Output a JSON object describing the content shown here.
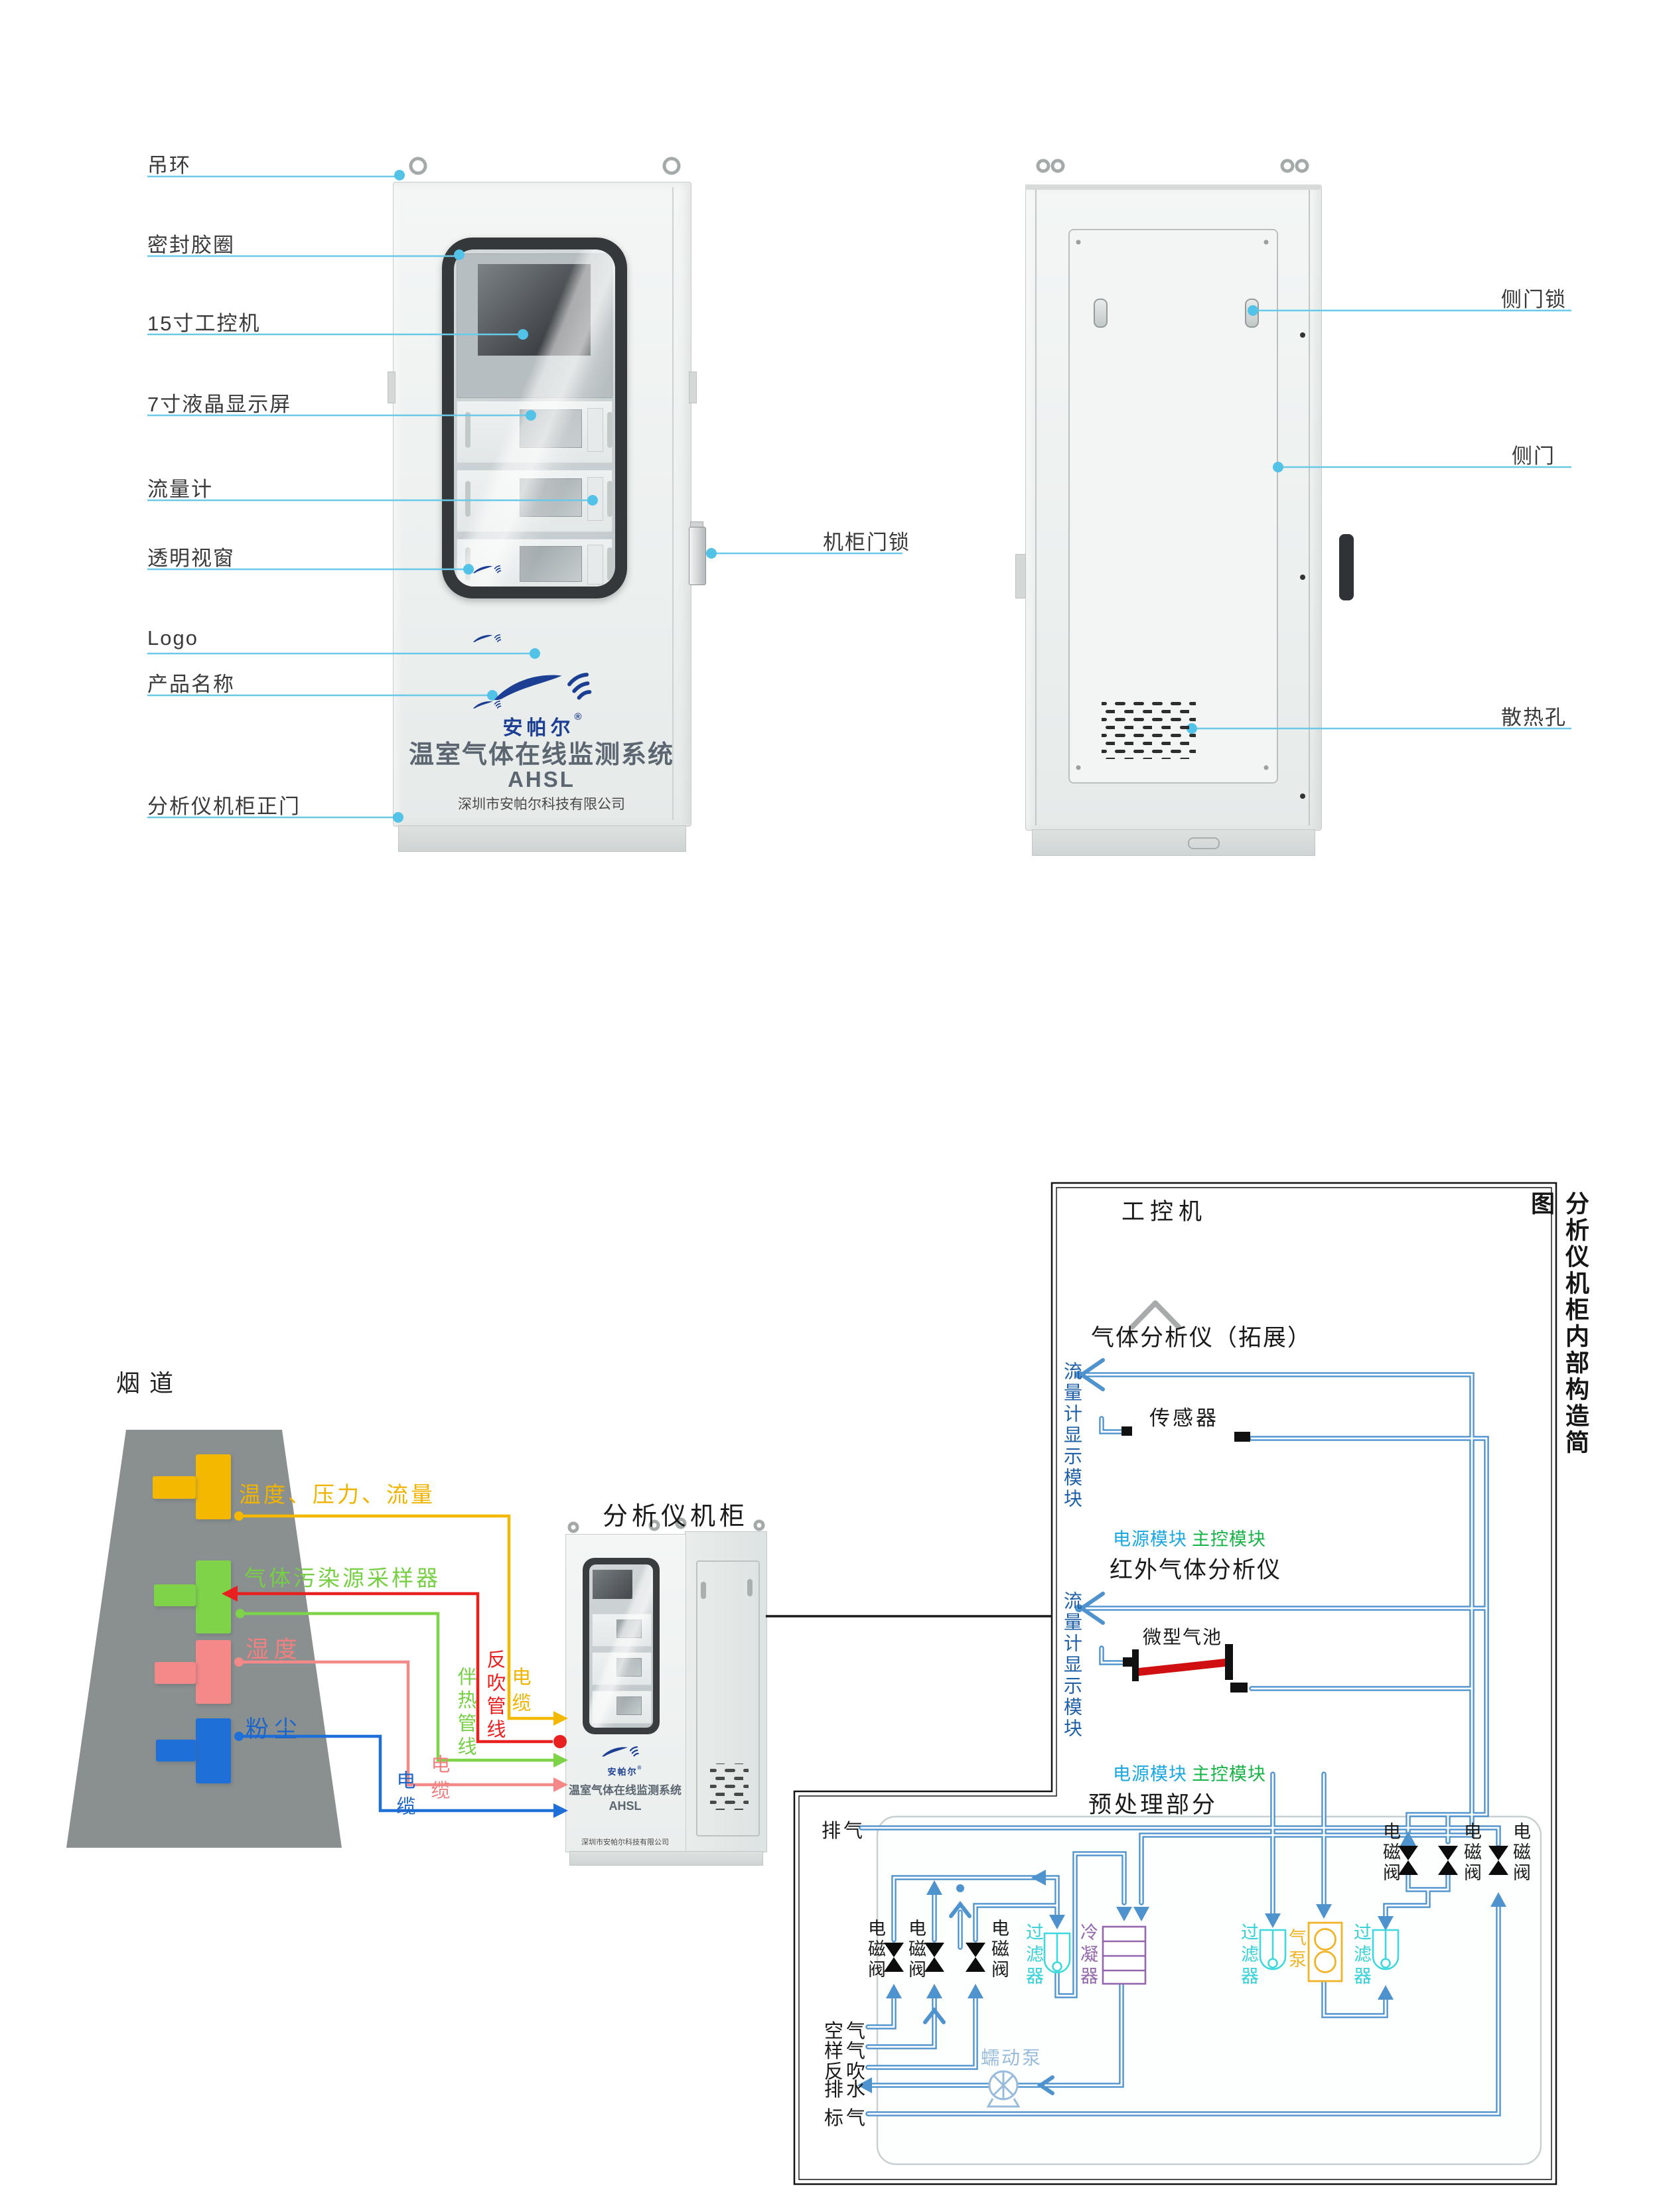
{
  "front_view": {
    "callouts_left": [
      {
        "label": "吊环"
      },
      {
        "label": "密封胶圈"
      },
      {
        "label": "15寸工控机"
      },
      {
        "label": "7寸液晶显示屏"
      },
      {
        "label": "流量计"
      },
      {
        "label": "透明视窗"
      },
      {
        "label": "Logo"
      },
      {
        "label": "产品名称"
      },
      {
        "label": "分析仪机柜正门"
      }
    ],
    "callout_right": {
      "label": "机柜门锁"
    },
    "brand": "安帕尔",
    "brand_reg": "®",
    "product_name": "温室气体在线监测系统",
    "model": "AHSL",
    "company": "深圳市安帕尔科技有限公司"
  },
  "back_view": {
    "callouts_right": [
      {
        "label": "侧门锁"
      },
      {
        "label": "侧门"
      },
      {
        "label": "散热孔"
      }
    ]
  },
  "site_diagram": {
    "flue_label": "烟道",
    "sources": [
      {
        "label": "温度、压力、流量",
        "color": "#f0b400"
      },
      {
        "label": "气体污染源采样器",
        "color": "#76cf44"
      },
      {
        "label": "湿度",
        "color": "#f28080"
      },
      {
        "label": "粉尘",
        "color": "#1d66c8"
      }
    ],
    "lines": {
      "cable_blue": "电缆",
      "cable_pink": "电缆",
      "heat_trace": "伴热管线",
      "backflush": "反吹管线",
      "cable_yellow": "电缆"
    },
    "cabinet_label": "分析仪机柜"
  },
  "panel": {
    "side_title": "分析仪机柜内部构造简图",
    "ipc_label": "工控机",
    "section1": {
      "title": "气体分析仪（拓展）",
      "flow_display": "流量计显示模块",
      "sensor": "传感器",
      "power": "电源模块",
      "main_ctrl": "主控模块"
    },
    "section2": {
      "title": "红外气体分析仪",
      "flow_display": "流量计显示模块",
      "gas_cell": "微型气池",
      "power": "电源模块",
      "main_ctrl": "主控模块"
    },
    "preprocess": {
      "title": "预处理部分",
      "solenoid_valve": "电磁阀",
      "filter": "过滤器",
      "condenser": "冷凝器",
      "gas_pump": "气泵",
      "peristaltic_pump": "蠕动泵",
      "exhaust": "排气",
      "ports": [
        {
          "label": "空气"
        },
        {
          "label": "样气"
        },
        {
          "label": "反吹"
        },
        {
          "label": "排水"
        },
        {
          "label": "标气"
        }
      ]
    }
  }
}
